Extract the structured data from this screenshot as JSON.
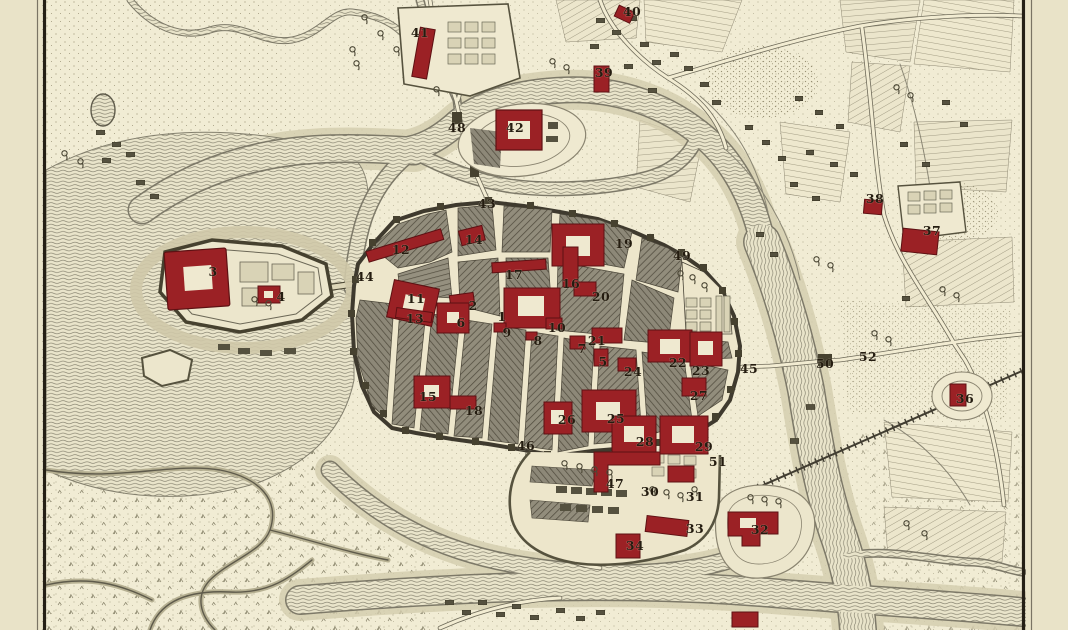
{
  "map": {
    "style": "antique-engraved-town-plan",
    "colors": {
      "paper": "#f0ebd3",
      "margin_paper": "#e9e3c8",
      "neatline_ink": "#241f15",
      "water_line": "#84806e",
      "terrain_stipple": "#8c8466",
      "town_block": "#8f8a7a",
      "town_wall": "#3f3a2e",
      "landmark_red": "#9b2125",
      "label_ink": "#241c10"
    },
    "labels": [
      {
        "n": "1",
        "x": 502,
        "y": 321
      },
      {
        "n": "2",
        "x": 473,
        "y": 310
      },
      {
        "n": "3",
        "x": 213,
        "y": 276
      },
      {
        "n": "4",
        "x": 281,
        "y": 301
      },
      {
        "n": "5",
        "x": 603,
        "y": 366
      },
      {
        "n": "6",
        "x": 461,
        "y": 327
      },
      {
        "n": "7",
        "x": 582,
        "y": 353
      },
      {
        "n": "8",
        "x": 538,
        "y": 345
      },
      {
        "n": "9",
        "x": 507,
        "y": 337
      },
      {
        "n": "10",
        "x": 557,
        "y": 332
      },
      {
        "n": "11",
        "x": 416,
        "y": 303
      },
      {
        "n": "12",
        "x": 401,
        "y": 254
      },
      {
        "n": "13",
        "x": 415,
        "y": 323
      },
      {
        "n": "14",
        "x": 474,
        "y": 244
      },
      {
        "n": "15",
        "x": 428,
        "y": 401
      },
      {
        "n": "16",
        "x": 571,
        "y": 288
      },
      {
        "n": "17",
        "x": 514,
        "y": 279
      },
      {
        "n": "18",
        "x": 474,
        "y": 415
      },
      {
        "n": "19",
        "x": 624,
        "y": 248
      },
      {
        "n": "20",
        "x": 601,
        "y": 301
      },
      {
        "n": "21",
        "x": 597,
        "y": 345
      },
      {
        "n": "22",
        "x": 678,
        "y": 367
      },
      {
        "n": "23",
        "x": 701,
        "y": 375
      },
      {
        "n": "24",
        "x": 633,
        "y": 376
      },
      {
        "n": "25",
        "x": 616,
        "y": 423
      },
      {
        "n": "26",
        "x": 567,
        "y": 424
      },
      {
        "n": "27",
        "x": 699,
        "y": 400
      },
      {
        "n": "28",
        "x": 645,
        "y": 446
      },
      {
        "n": "29",
        "x": 704,
        "y": 451
      },
      {
        "n": "30",
        "x": 650,
        "y": 496
      },
      {
        "n": "31",
        "x": 695,
        "y": 501
      },
      {
        "n": "32",
        "x": 760,
        "y": 534
      },
      {
        "n": "33",
        "x": 695,
        "y": 533
      },
      {
        "n": "34",
        "x": 635,
        "y": 550
      },
      {
        "n": "36",
        "x": 965,
        "y": 403
      },
      {
        "n": "37",
        "x": 932,
        "y": 235
      },
      {
        "n": "38",
        "x": 875,
        "y": 203
      },
      {
        "n": "39",
        "x": 604,
        "y": 77
      },
      {
        "n": "40",
        "x": 632,
        "y": 16
      },
      {
        "n": "41",
        "x": 420,
        "y": 37
      },
      {
        "n": "42",
        "x": 515,
        "y": 132
      },
      {
        "n": "43",
        "x": 487,
        "y": 208
      },
      {
        "n": "44",
        "x": 365,
        "y": 281
      },
      {
        "n": "45",
        "x": 749,
        "y": 373
      },
      {
        "n": "46",
        "x": 526,
        "y": 450
      },
      {
        "n": "47",
        "x": 615,
        "y": 488
      },
      {
        "n": "48",
        "x": 457,
        "y": 132
      },
      {
        "n": "49",
        "x": 682,
        "y": 260
      },
      {
        "n": "50",
        "x": 825,
        "y": 368
      },
      {
        "n": "51",
        "x": 718,
        "y": 466
      },
      {
        "n": "52",
        "x": 868,
        "y": 361
      }
    ]
  }
}
